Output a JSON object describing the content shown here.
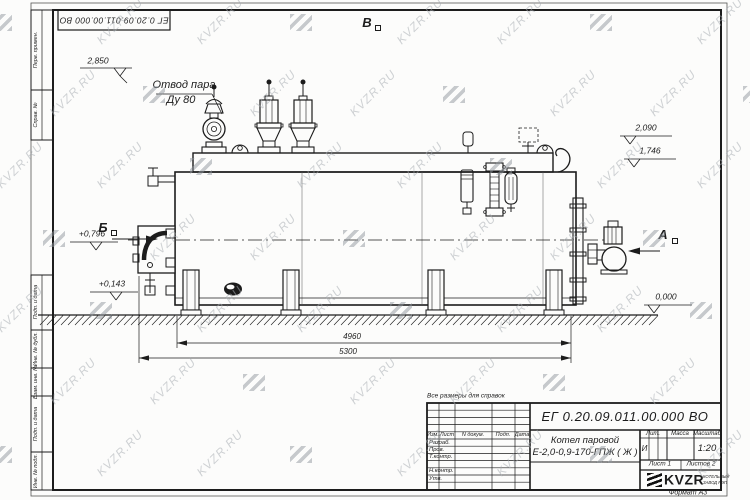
{
  "meta": {
    "format_note": "Формат А3",
    "ref_note": "Все размеры для справок"
  },
  "doc": {
    "number": "ЕГ 0.20.09.011.00.000  ВО",
    "name_line1": "Котел паровой",
    "name_line2": "Е-2,0-0,9-170-ГПЖ ( Ж )",
    "liter": "И",
    "scale": "1:20",
    "sheet": "Лист 1",
    "sheets": "Листов 2"
  },
  "title_block": {
    "cols": {
      "izm": "Изм.",
      "list": "Лист",
      "ndoc": "N докум.",
      "podp": "Подп.",
      "data": "Дата"
    },
    "rows": {
      "razrab": "Разраб.",
      "prov": "Пров.",
      "tkontr": "Т.контр.",
      "nkontr": "Н.контр.",
      "utv": "Утв."
    },
    "headers": {
      "lit": "Лит.",
      "mass": "Масса",
      "scale": "Масштаб"
    }
  },
  "logo": {
    "brand": "KVZR",
    "sub1": "КОТЕЛЬНЫЙ",
    "sub2": "ЗАВОД РЭП"
  },
  "border_stamps": {
    "c1": "Перв. примен.",
    "c2": "Справ. №",
    "c3": "Подп. и дата",
    "c4": "Инв. № дубл.",
    "c5": "Взам. инв. №",
    "c6": "Подп. и дата",
    "c7": "Инв. № подл."
  },
  "annotations": {
    "steam_outlet_1": "Отвод пара",
    "steam_outlet_2": "Ду 80",
    "view_a": "А",
    "view_b": "Б",
    "view_v": "В"
  },
  "dimensions": {
    "body_length": "4960",
    "overall_length": "5300"
  },
  "elevations": {
    "valve_top": "2,850",
    "drum_top": "2,090",
    "shell_top": "1,746",
    "burner_axis": "+0,796",
    "base": "+0,143",
    "ground": "0,000"
  },
  "watermark": {
    "text": "KVZR.RU",
    "color": "#a9aeb4"
  },
  "colors": {
    "line": "#1c1c1c",
    "paper": "#fcfcfb"
  }
}
